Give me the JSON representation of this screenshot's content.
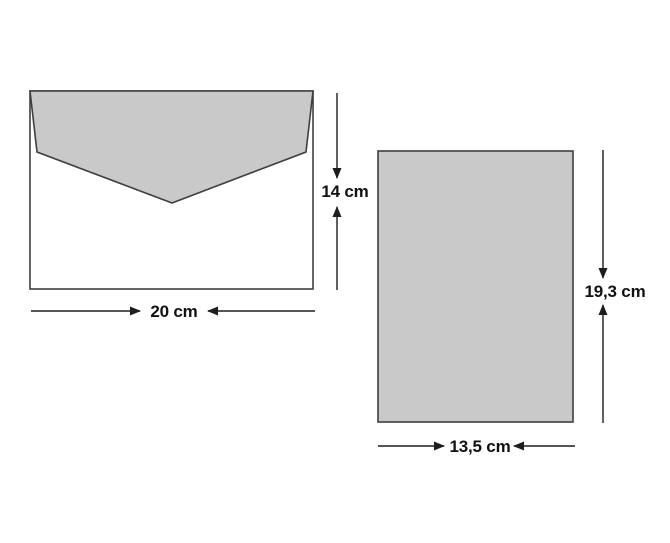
{
  "figure": {
    "title": "envelope-and-card-dimensions",
    "envelope": {
      "width_label": "20 cm",
      "height_label": "14 cm"
    },
    "card": {
      "width_label": "13,5 cm",
      "height_label": "19,3 cm"
    },
    "colors": {
      "background": "#ffffff",
      "shape_fill": "#c9c9c9",
      "envelope_body_fill": "#ffffff",
      "shape_stroke": "#3f3f3f",
      "dimension_color": "#1d1d1d"
    }
  }
}
